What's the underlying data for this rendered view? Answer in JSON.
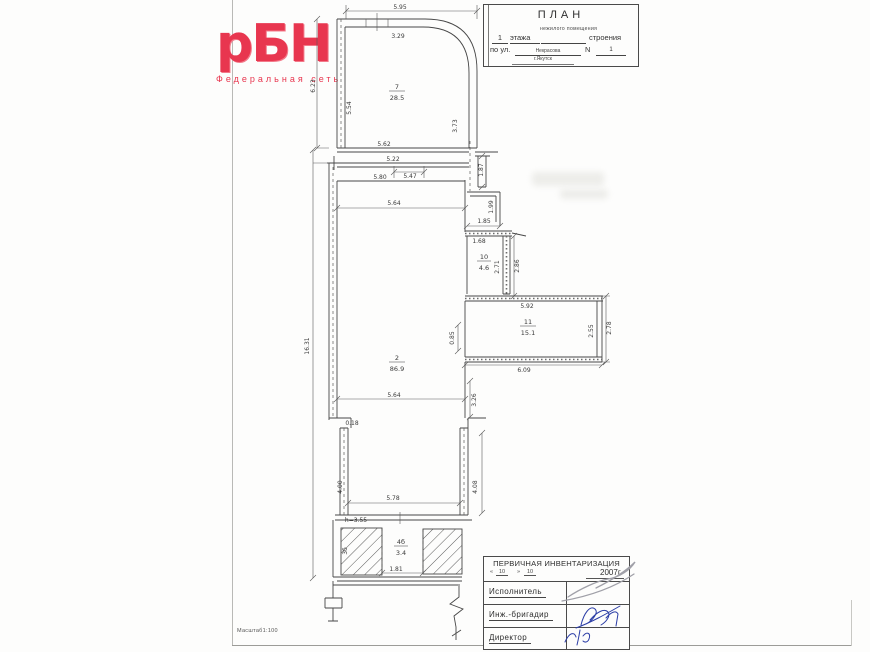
{
  "page": {
    "scale_note": "Масштаб1:100"
  },
  "logo": {
    "text": "рБН",
    "subtitle": "Федеральная сеть",
    "color": "#e8364f"
  },
  "title_block": {
    "title": "ПЛАН",
    "subscript": "нежилого помещения",
    "floor_num": "1",
    "floor_word": "этажа",
    "building_word": "строения",
    "street_label": "по ул.",
    "street_name": "Некрасова",
    "number_label": "N",
    "number_value": "1",
    "city": "г.Якутск"
  },
  "stamp_block": {
    "title": "ПЕРВИЧНАЯ ИНВЕНТАРИЗАЦИЯ",
    "date_open": "«",
    "date_day": "10",
    "date_close": "»",
    "date_month": "10",
    "date_year": "2007г.",
    "rows": [
      {
        "label": "Исполнитель"
      },
      {
        "label": "Инж.-бригадир"
      },
      {
        "label": "Директор"
      }
    ]
  },
  "plan": {
    "rooms": [
      {
        "num": "7",
        "area": "28.5"
      },
      {
        "num": "2",
        "area": "86.9"
      },
      {
        "num": "10",
        "area": "4.6"
      },
      {
        "num": "11",
        "area": "15.1"
      },
      {
        "num": "4б",
        "area": "3.4"
      }
    ],
    "dims": {
      "a595": "5.95",
      "a329": "3.29",
      "a623": "6.23",
      "a554": "5.54",
      "a373": "3.73",
      "a562": "5.62",
      "a522": "5.22",
      "a547": "5.47",
      "a580": "5.80",
      "a187": "1.87",
      "a564": "5.64",
      "a199": "1.99",
      "a185": "1.85",
      "a168": "1.68",
      "a271": "2.71",
      "a286": "2.86",
      "a592": "5.92",
      "a255": "2.55",
      "a278": "2.78",
      "a609": "6.09",
      "a085": "0.85",
      "a1631": "16.31",
      "a564b": "5.64",
      "a326": "3.26",
      "a018": "0.18",
      "a400": "4.00",
      "a408": "4.08",
      "a578": "5.78",
      "a181": "1.81"
    },
    "notes": {
      "height": "h=3.55",
      "left_room": "3б"
    }
  }
}
